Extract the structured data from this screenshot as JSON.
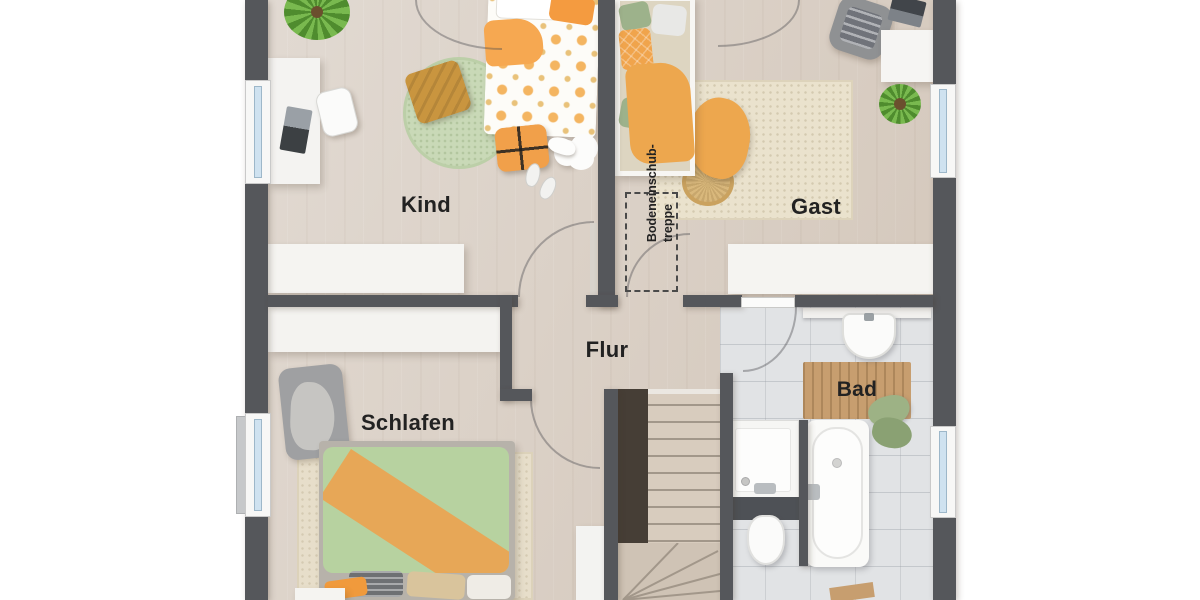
{
  "rooms": {
    "kind": {
      "label": "Kind"
    },
    "gast": {
      "label": "Gast"
    },
    "flur": {
      "label": "Flur"
    },
    "schlafen": {
      "label": "Schlafen"
    },
    "bad": {
      "label": "Bad"
    }
  },
  "annotations": {
    "attic_stairs": {
      "line1": "Bodeneinschub-",
      "line2": "treppe"
    }
  },
  "colors": {
    "wall": "#55575b",
    "wood_floor": "#d9cfc5",
    "tile_floor": "#e1e3e5",
    "window_glass": "#cfe2f0",
    "accent_orange": "#f0a44c",
    "accent_green": "#b7d2a0",
    "bath_mat_wood": "#c79e6f"
  }
}
